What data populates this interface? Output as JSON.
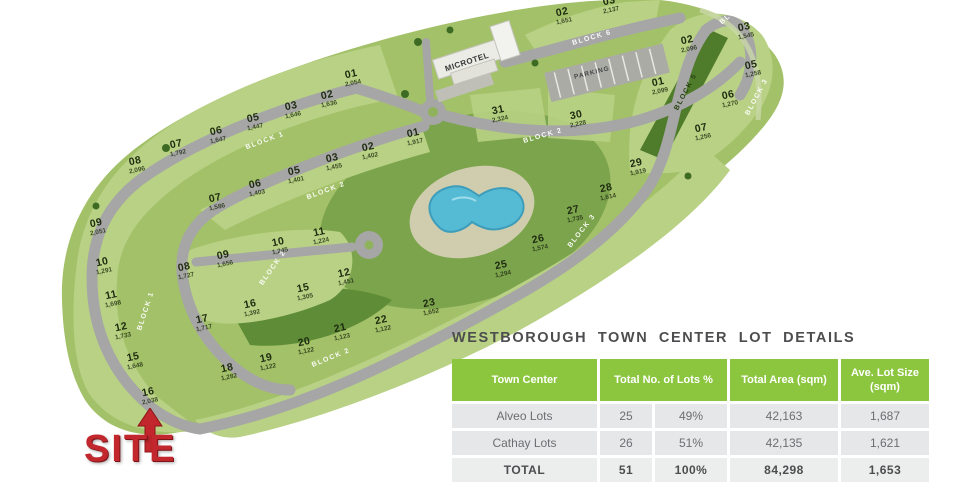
{
  "site_plan": {
    "site_label": "SITE",
    "hotel_label": "MICROTEL",
    "parking_label": "PARKING",
    "lots": [
      {
        "no": "01",
        "area": "2,054",
        "x": 352,
        "y": 78
      },
      {
        "no": "02",
        "area": "1,636",
        "x": 328,
        "y": 99
      },
      {
        "no": "03",
        "area": "1,646",
        "x": 292,
        "y": 110
      },
      {
        "no": "05",
        "area": "1,447",
        "x": 254,
        "y": 122
      },
      {
        "no": "06",
        "area": "1,647",
        "x": 217,
        "y": 135
      },
      {
        "no": "07",
        "area": "1,792",
        "x": 177,
        "y": 148
      },
      {
        "no": "08",
        "area": "2,096",
        "x": 136,
        "y": 165
      },
      {
        "no": "09",
        "area": "2,051",
        "x": 97,
        "y": 227
      },
      {
        "no": "10",
        "area": "1,291",
        "x": 103,
        "y": 266
      },
      {
        "no": "11",
        "area": "1,698",
        "x": 112,
        "y": 299
      },
      {
        "no": "12",
        "area": "1,733",
        "x": 122,
        "y": 331
      },
      {
        "no": "15",
        "area": "1,648",
        "x": 134,
        "y": 361
      },
      {
        "no": "16",
        "area": "2,038",
        "x": 149,
        "y": 396
      },
      {
        "no": "01",
        "area": "1,917",
        "x": 414,
        "y": 137
      },
      {
        "no": "02",
        "area": "1,402",
        "x": 369,
        "y": 151
      },
      {
        "no": "03",
        "area": "1,455",
        "x": 333,
        "y": 162
      },
      {
        "no": "05",
        "area": "1,401",
        "x": 295,
        "y": 175
      },
      {
        "no": "06",
        "area": "1,403",
        "x": 256,
        "y": 188
      },
      {
        "no": "07",
        "area": "1,586",
        "x": 216,
        "y": 202
      },
      {
        "no": "08",
        "area": "1,727",
        "x": 185,
        "y": 271
      },
      {
        "no": "09",
        "area": "1,656",
        "x": 224,
        "y": 259
      },
      {
        "no": "10",
        "area": "1,245",
        "x": 279,
        "y": 246
      },
      {
        "no": "11",
        "area": "1,224",
        "x": 320,
        "y": 236
      },
      {
        "no": "12",
        "area": "1,451",
        "x": 345,
        "y": 277
      },
      {
        "no": "15",
        "area": "1,305",
        "x": 304,
        "y": 292
      },
      {
        "no": "16",
        "area": "1,392",
        "x": 251,
        "y": 308
      },
      {
        "no": "17",
        "area": "1,717",
        "x": 203,
        "y": 323
      },
      {
        "no": "18",
        "area": "1,282",
        "x": 228,
        "y": 372
      },
      {
        "no": "19",
        "area": "1,122",
        "x": 267,
        "y": 362
      },
      {
        "no": "20",
        "area": "1,122",
        "x": 305,
        "y": 346
      },
      {
        "no": "21",
        "area": "1,123",
        "x": 341,
        "y": 332
      },
      {
        "no": "22",
        "area": "1,122",
        "x": 382,
        "y": 324
      },
      {
        "no": "23",
        "area": "1,652",
        "x": 430,
        "y": 307
      },
      {
        "no": "25",
        "area": "1,294",
        "x": 502,
        "y": 269
      },
      {
        "no": "26",
        "area": "1,574",
        "x": 539,
        "y": 243
      },
      {
        "no": "27",
        "area": "1,735",
        "x": 574,
        "y": 214
      },
      {
        "no": "28",
        "area": "1,614",
        "x": 607,
        "y": 192
      },
      {
        "no": "29",
        "area": "1,919",
        "x": 637,
        "y": 167
      },
      {
        "no": "31",
        "area": "2,324",
        "x": 499,
        "y": 114
      },
      {
        "no": "30",
        "area": "2,228",
        "x": 577,
        "y": 119
      },
      {
        "no": "01",
        "area": "2,099",
        "x": 659,
        "y": 86
      },
      {
        "no": "02",
        "area": "2,096",
        "x": 688,
        "y": 44
      },
      {
        "no": "03",
        "area": "1,545",
        "x": 745,
        "y": 31
      },
      {
        "no": "05",
        "area": "1,258",
        "x": 752,
        "y": 69
      },
      {
        "no": "06",
        "area": "1,270",
        "x": 729,
        "y": 99
      },
      {
        "no": "07",
        "area": "1,256",
        "x": 702,
        "y": 132
      },
      {
        "no": "02",
        "area": "1,651",
        "x": 563,
        "y": 16
      },
      {
        "no": "03",
        "area": "2,137",
        "x": 610,
        "y": 5
      }
    ],
    "road_labels": [
      {
        "text": "BLOCK 1",
        "x": 265,
        "y": 141,
        "rot": -20,
        "style": "light"
      },
      {
        "text": "BLOCK 2",
        "x": 326,
        "y": 191,
        "rot": -20,
        "style": "light"
      },
      {
        "text": "BLOCK 2",
        "x": 543,
        "y": 136,
        "rot": -16,
        "style": "light"
      },
      {
        "text": "BLOCK 1",
        "x": 146,
        "y": 311,
        "rot": -72,
        "style": "light"
      },
      {
        "text": "BLOCK 2",
        "x": 273,
        "y": 268,
        "rot": -55,
        "style": "light"
      },
      {
        "text": "BLOCK 2",
        "x": 331,
        "y": 358,
        "rot": -22,
        "style": "light"
      },
      {
        "text": "BLOCK 3",
        "x": 582,
        "y": 231,
        "rot": -52,
        "style": "light"
      },
      {
        "text": "BLOCK 6",
        "x": 592,
        "y": 38,
        "rot": -16,
        "style": "light"
      },
      {
        "text": "BLOCK 6",
        "x": 736,
        "y": 10,
        "rot": -42,
        "style": "light"
      },
      {
        "text": "BLOCK 5",
        "x": 686,
        "y": 92,
        "rot": -62,
        "style": "dark"
      },
      {
        "text": "BLOCK 3",
        "x": 757,
        "y": 97,
        "rot": -62,
        "style": "light"
      }
    ]
  },
  "details": {
    "title": "WESTBOROUGH TOWN CENTER LOT DETAILS",
    "table": {
      "headers": [
        "Town Center",
        "Total No. of Lots %",
        "Total Area (sqm)",
        "Ave. Lot Size (sqm)"
      ],
      "rows": [
        {
          "name": "Alveo Lots",
          "lots": "25",
          "pct": "49%",
          "area": "42,163",
          "avg": "1,687"
        },
        {
          "name": "Cathay Lots",
          "lots": "26",
          "pct": "51%",
          "area": "42,135",
          "avg": "1,621"
        },
        {
          "name": "TOTAL",
          "lots": "51",
          "pct": "100%",
          "area": "84,298",
          "avg": "1,653",
          "total": true
        }
      ]
    }
  },
  "chart_data": {
    "type": "table",
    "title": "WESTBOROUGH TOWN CENTER LOT DETAILS",
    "columns": [
      "Town Center",
      "Total No. of Lots",
      "%",
      "Total Area (sqm)",
      "Ave. Lot Size (sqm)"
    ],
    "rows": [
      [
        "Alveo Lots",
        25,
        "49%",
        42163,
        1687
      ],
      [
        "Cathay Lots",
        26,
        "51%",
        42135,
        1621
      ],
      [
        "TOTAL",
        51,
        "100%",
        84298,
        1653
      ]
    ]
  },
  "colors": {
    "table_header_green": "#8cc63f",
    "table_row_gray": "#e6e7e8",
    "text_gray": "#6d6e71",
    "site_red": "#c1272d",
    "parcel_green": "#a3c169",
    "lot_light_green": "#b8d184",
    "park_green": "#7ca44d",
    "road_gray": "#a6a6a6",
    "pool_blue": "#55bbd4"
  }
}
